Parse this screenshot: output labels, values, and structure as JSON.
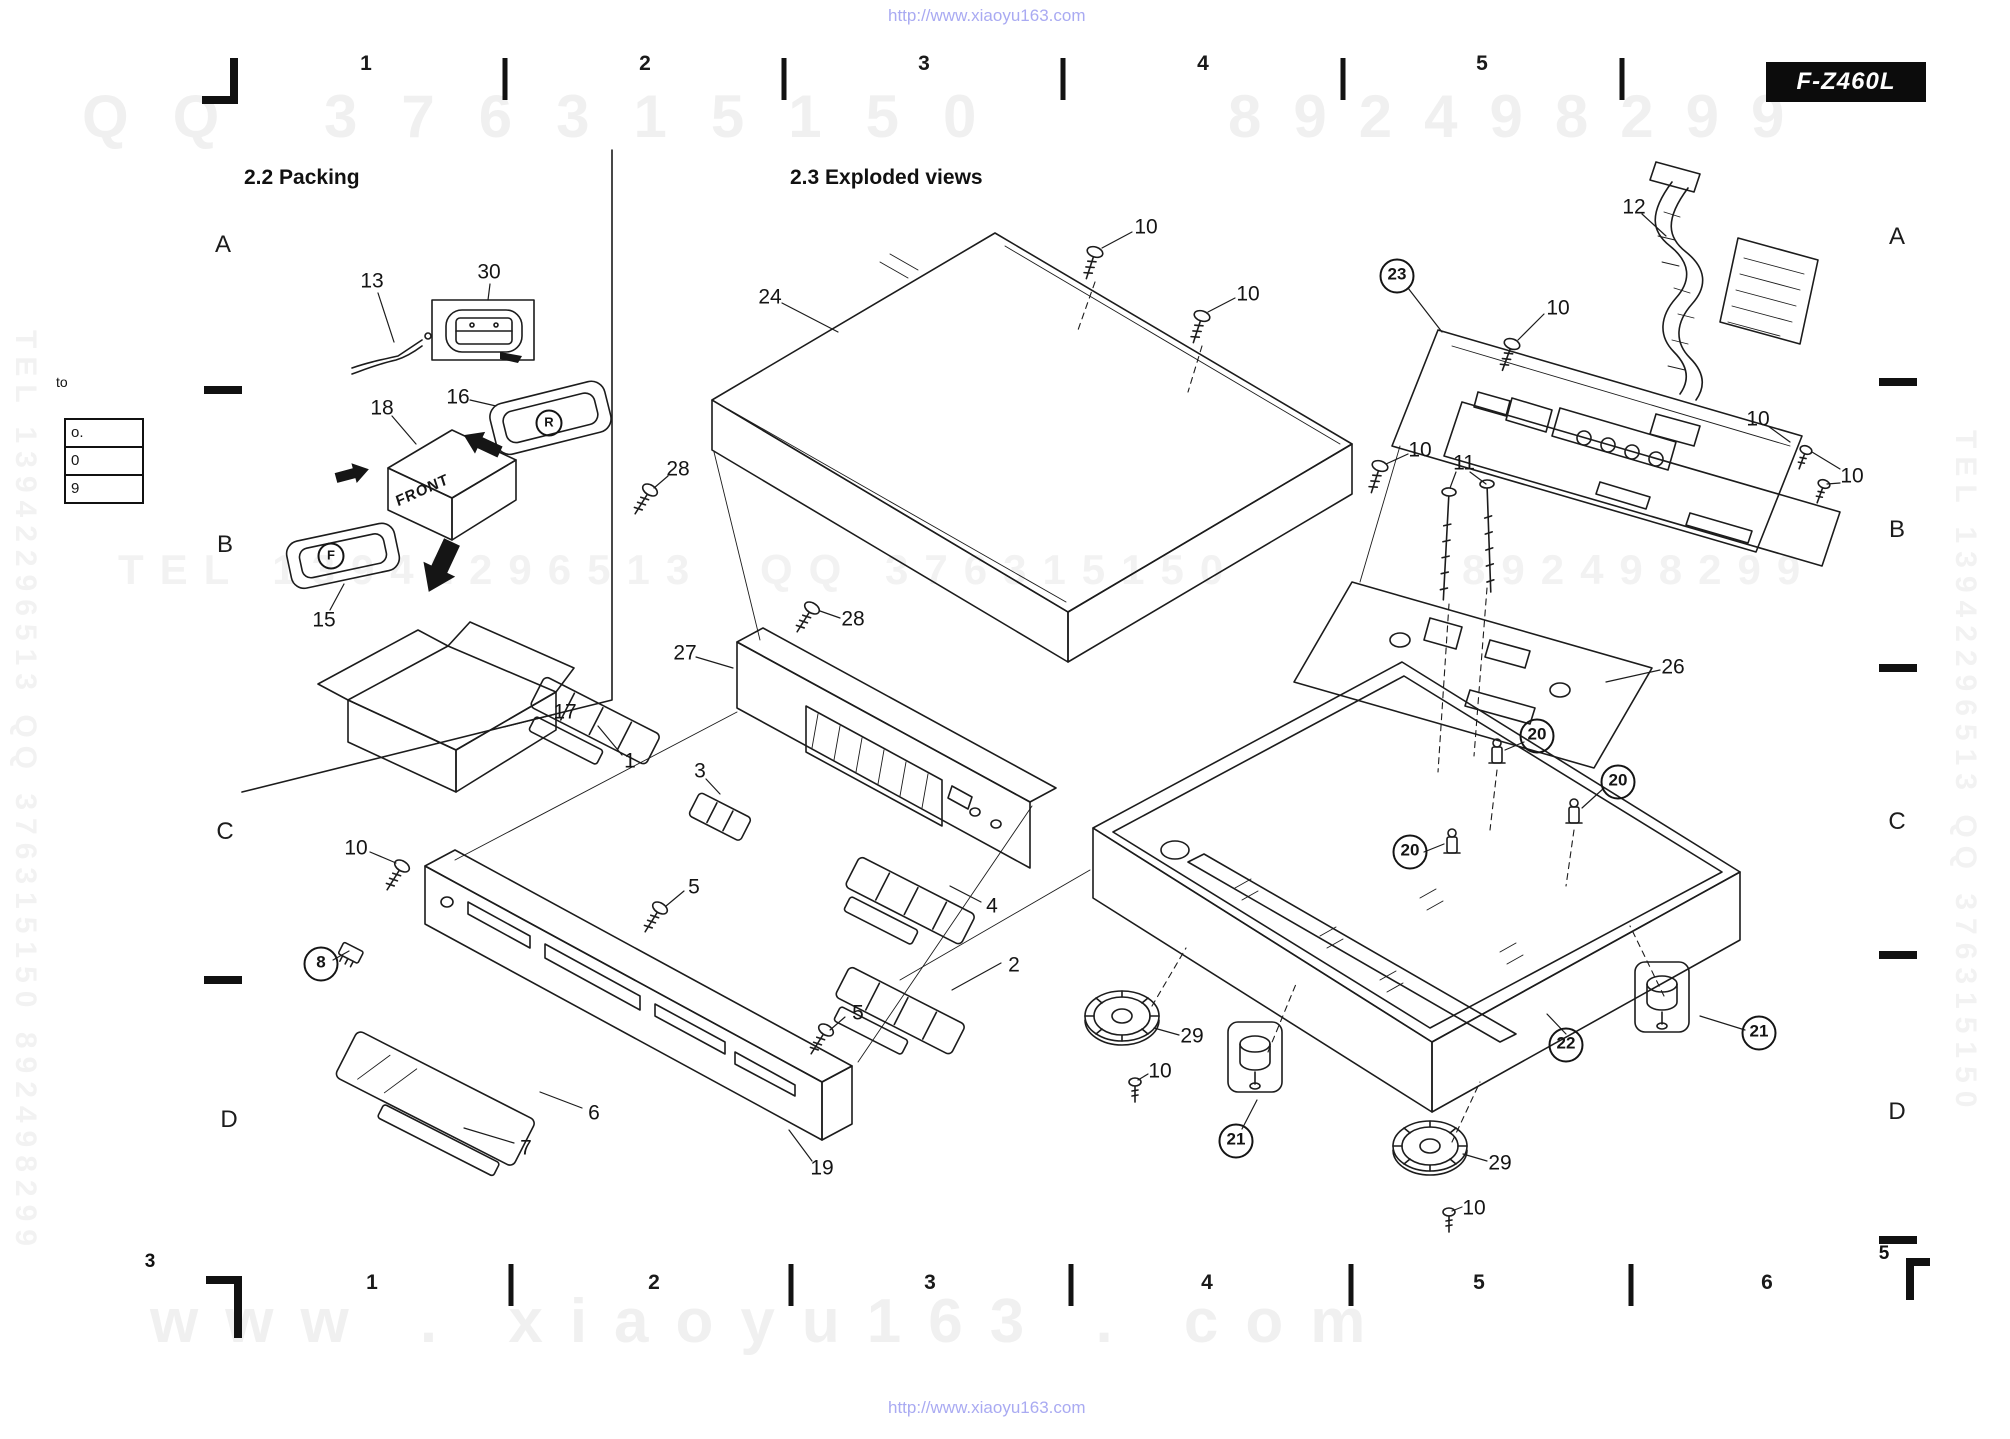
{
  "header": {
    "model_badge": "F-Z460L"
  },
  "sections": {
    "packing": "2.2 Packing",
    "exploded": "2.3 Exploded views"
  },
  "watermarks": {
    "url_top": "http://www.xiaoyu163.com",
    "url_bottom": "http://www.xiaoyu163.com",
    "url_color": "#a9aaf2",
    "gray_color": "#f0f0f0",
    "top_row_left": "QQ 376315150",
    "top_row_right": "892498299",
    "mid_row_left": "TEL 13942296513",
    "mid_row_center": "QQ 376315150",
    "mid_row_right": "892498299",
    "bottom_big": "www . xiaoyu163 . com",
    "side_left": "TEL 13942296513 QQ 376315150 892498299",
    "side_right": "TEL 13942296513 QQ 376315150"
  },
  "grid": {
    "page_number_left": "3",
    "page_number_right": "5",
    "top_numbers": [
      {
        "text": "1",
        "x": 366
      },
      {
        "text": "2",
        "x": 645
      },
      {
        "text": "3",
        "x": 924
      },
      {
        "text": "4",
        "x": 1203
      },
      {
        "text": "5",
        "x": 1482
      }
    ],
    "top_ticks": [
      {
        "x": 505
      },
      {
        "x": 784
      },
      {
        "x": 1063
      },
      {
        "x": 1343
      },
      {
        "x": 1622
      }
    ],
    "bottom_numbers": [
      {
        "text": "1",
        "x": 372
      },
      {
        "text": "2",
        "x": 654
      },
      {
        "text": "3",
        "x": 930
      },
      {
        "text": "4",
        "x": 1207
      },
      {
        "text": "5",
        "x": 1479
      },
      {
        "text": "6",
        "x": 1767
      }
    ],
    "bottom_ticks": [
      {
        "x": 511
      },
      {
        "x": 791
      },
      {
        "x": 1071
      },
      {
        "x": 1351
      },
      {
        "x": 1631
      }
    ],
    "left_letters": [
      {
        "text": "A",
        "x": 223,
        "y": 245
      },
      {
        "text": "B",
        "x": 225,
        "y": 545
      },
      {
        "text": "C",
        "x": 225,
        "y": 832
      },
      {
        "text": "D",
        "x": 229,
        "y": 1120
      }
    ],
    "right_letters": [
      {
        "text": "A",
        "x": 1897,
        "y": 237
      },
      {
        "text": "B",
        "x": 1897,
        "y": 530
      },
      {
        "text": "C",
        "x": 1897,
        "y": 822
      },
      {
        "text": "D",
        "x": 1897,
        "y": 1112
      }
    ],
    "left_dashes": [
      {
        "x": 223,
        "y": 390
      },
      {
        "x": 223,
        "y": 980
      }
    ],
    "right_dashes": [
      {
        "x": 1898,
        "y": 382
      },
      {
        "x": 1898,
        "y": 668
      },
      {
        "x": 1898,
        "y": 955
      },
      {
        "x": 1898,
        "y": 1240
      }
    ]
  },
  "margin_notes": {
    "to_label": "to",
    "table_rows": [
      {
        "text": "o."
      },
      {
        "text": "0"
      },
      {
        "text": "9"
      }
    ]
  },
  "diagram": {
    "annotations": {
      "front": "FRONT",
      "right_cap": "R",
      "front_cap": "F"
    },
    "part_labels": [
      {
        "text": "13",
        "x": 372,
        "y": 281
      },
      {
        "text": "30",
        "x": 489,
        "y": 272
      },
      {
        "text": "16",
        "x": 458,
        "y": 397
      },
      {
        "text": "18",
        "x": 382,
        "y": 408
      },
      {
        "text": "15",
        "x": 324,
        "y": 620
      },
      {
        "text": "17",
        "x": 565,
        "y": 712
      },
      {
        "text": "24",
        "x": 770,
        "y": 297
      },
      {
        "text": "10",
        "x": 1146,
        "y": 227
      },
      {
        "text": "10",
        "x": 1248,
        "y": 294
      },
      {
        "text": "10",
        "x": 1420,
        "y": 450
      },
      {
        "text": "12",
        "x": 1634,
        "y": 207
      },
      {
        "text": "23",
        "x": 1397,
        "y": 276,
        "circled": true
      },
      {
        "text": "10",
        "x": 1558,
        "y": 308
      },
      {
        "text": "10",
        "x": 1758,
        "y": 419
      },
      {
        "text": "10",
        "x": 1852,
        "y": 476
      },
      {
        "text": "11",
        "x": 1464,
        "y": 463
      },
      {
        "text": "26",
        "x": 1673,
        "y": 667
      },
      {
        "text": "20",
        "x": 1537,
        "y": 736,
        "circled": true
      },
      {
        "text": "20",
        "x": 1618,
        "y": 782,
        "circled": true
      },
      {
        "text": "20",
        "x": 1410,
        "y": 852,
        "circled": true
      },
      {
        "text": "28",
        "x": 678,
        "y": 469
      },
      {
        "text": "27",
        "x": 685,
        "y": 653
      },
      {
        "text": "28",
        "x": 853,
        "y": 619
      },
      {
        "text": "1",
        "x": 630,
        "y": 761
      },
      {
        "text": "3",
        "x": 700,
        "y": 771
      },
      {
        "text": "5",
        "x": 694,
        "y": 887
      },
      {
        "text": "10",
        "x": 356,
        "y": 848
      },
      {
        "text": "8",
        "x": 321,
        "y": 964,
        "circled": true
      },
      {
        "text": "4",
        "x": 992,
        "y": 906
      },
      {
        "text": "2",
        "x": 1014,
        "y": 965
      },
      {
        "text": "5",
        "x": 858,
        "y": 1013
      },
      {
        "text": "29",
        "x": 1192,
        "y": 1036
      },
      {
        "text": "10",
        "x": 1160,
        "y": 1071
      },
      {
        "text": "6",
        "x": 594,
        "y": 1113
      },
      {
        "text": "7",
        "x": 526,
        "y": 1148
      },
      {
        "text": "19",
        "x": 822,
        "y": 1168
      },
      {
        "text": "21",
        "x": 1236,
        "y": 1141,
        "circled": true
      },
      {
        "text": "29",
        "x": 1500,
        "y": 1163
      },
      {
        "text": "10",
        "x": 1474,
        "y": 1208
      },
      {
        "text": "22",
        "x": 1566,
        "y": 1045,
        "circled": true
      },
      {
        "text": "21",
        "x": 1759,
        "y": 1033,
        "circled": true
      }
    ]
  }
}
